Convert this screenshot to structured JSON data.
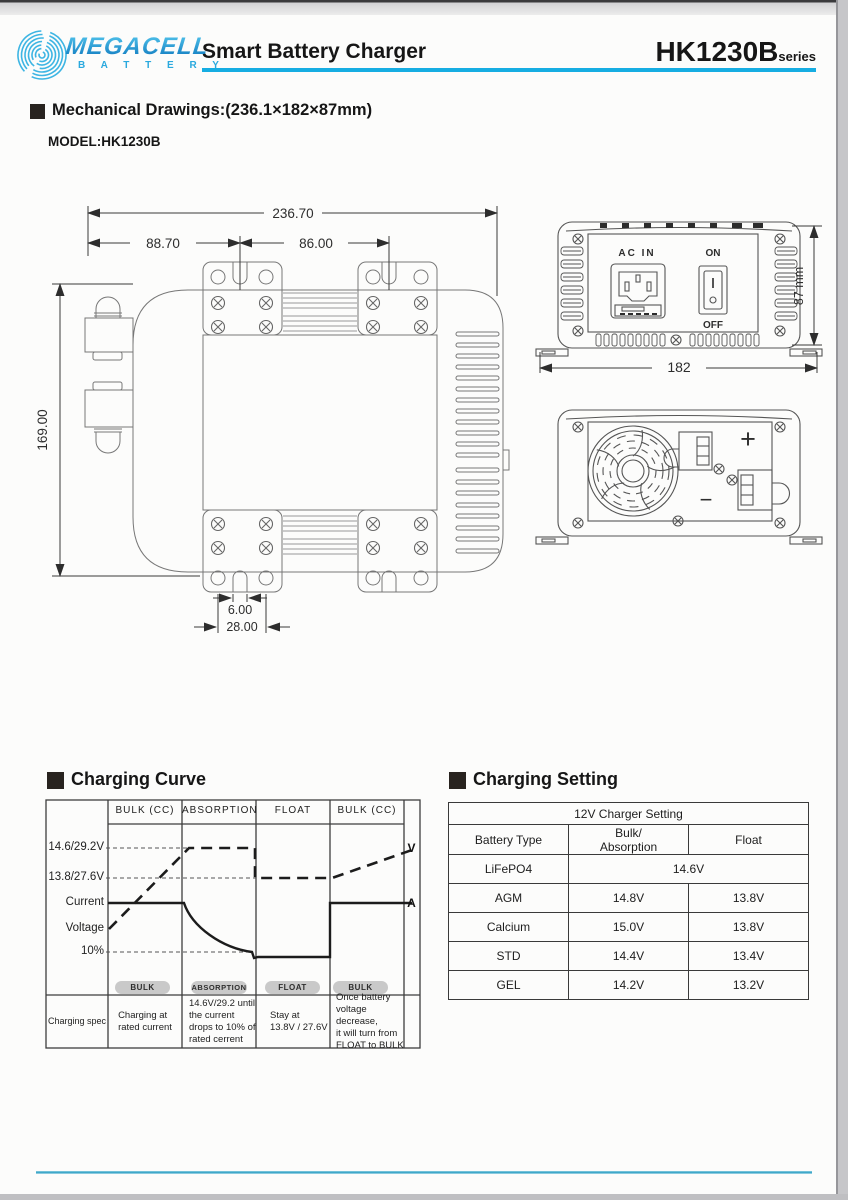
{
  "header": {
    "brand": "MEGACELL",
    "brand_sub": "B A T T E R Y",
    "title": "Smart Battery Charger",
    "model": "HK1230B",
    "model_suffix": "series",
    "accent_color": "#16ade2"
  },
  "mechanical": {
    "section_title": "Mechanical Drawings:(236.1×182×87mm)",
    "model_label": "MODEL:HK1230B",
    "top_view": {
      "dim_total_width": "236.70",
      "dim_left_width": "88.70",
      "dim_right_width": "86.00",
      "dim_height": "169.00",
      "dim_notch_width": "6.00",
      "dim_hole_pitch": "28.00"
    },
    "front_view": {
      "label_ac_in": "AC IN",
      "label_on": "ON",
      "label_off": "OFF",
      "dim_height": "87 mm",
      "dim_width": "182"
    },
    "rear_view": {
      "label_plus": "+",
      "label_minus": "−"
    }
  },
  "chart_section_title": "Charging Curve",
  "chart_data": {
    "type": "line",
    "title": "Charging Curve",
    "x_phases": [
      "BULK (CC)",
      "ABSORPTION",
      "FLOAT",
      "BULK (CC)"
    ],
    "y_axis_labels": [
      "14.6/29.2V",
      "13.8/27.6V",
      "Current",
      "Voltage",
      "10%"
    ],
    "right_axis_markers": {
      "voltage": "V",
      "current": "A"
    },
    "series": [
      {
        "name": "Voltage",
        "line_style": "dashed",
        "units": "V (12V system / 24V system)",
        "points": [
          {
            "phase": "BULK (CC)",
            "start": 13.2,
            "end": 14.6
          },
          {
            "phase": "ABSORPTION",
            "start": 14.6,
            "end": 14.6
          },
          {
            "phase": "FLOAT",
            "start": 13.8,
            "end": 13.8
          },
          {
            "phase": "BULK (CC)",
            "start": 13.8,
            "end": 14.5
          }
        ]
      },
      {
        "name": "Current",
        "line_style": "solid",
        "units": "% of rated current",
        "points": [
          {
            "phase": "BULK (CC)",
            "start": 100,
            "end": 100
          },
          {
            "phase": "ABSORPTION",
            "start": 100,
            "end": 10
          },
          {
            "phase": "FLOAT",
            "start": 9,
            "end": 9
          },
          {
            "phase": "BULK (CC)",
            "start": 100,
            "end": 100
          }
        ]
      }
    ],
    "grid_levels": {
      "absorption_voltage": "14.6/29.2V",
      "float_voltage": "13.8/27.6V",
      "cutoff_current": "10%"
    },
    "phase_pills": [
      "BULK",
      "ABSORPTION",
      "FLOAT",
      "BULK"
    ],
    "spec_row": {
      "header": "Charging spec",
      "notes": [
        "Charging at\nrated current",
        "14.6V/29.2 until\nthe current\ndrops to 10% of\nrated cerrent",
        "Stay at\n13.8V / 27.6V",
        "Once battery\nvoltage decrease,\nit will turn from\nFLOAT to BULK"
      ]
    }
  },
  "setting_section_title": "Charging Setting",
  "setting_table": {
    "title": "12V Charger Setting",
    "columns": [
      "Battery Type",
      "Bulk/\nAbsorption",
      "Float"
    ],
    "rows": [
      {
        "type": "LiFePO4",
        "bulk_absorption": "14.6V",
        "float": "",
        "merged": true
      },
      {
        "type": "AGM",
        "bulk_absorption": "14.8V",
        "float": "13.8V"
      },
      {
        "type": "Calcium",
        "bulk_absorption": "15.0V",
        "float": "13.8V"
      },
      {
        "type": "STD",
        "bulk_absorption": "14.4V",
        "float": "13.4V"
      },
      {
        "type": "GEL",
        "bulk_absorption": "14.2V",
        "float": "13.2V"
      }
    ]
  }
}
